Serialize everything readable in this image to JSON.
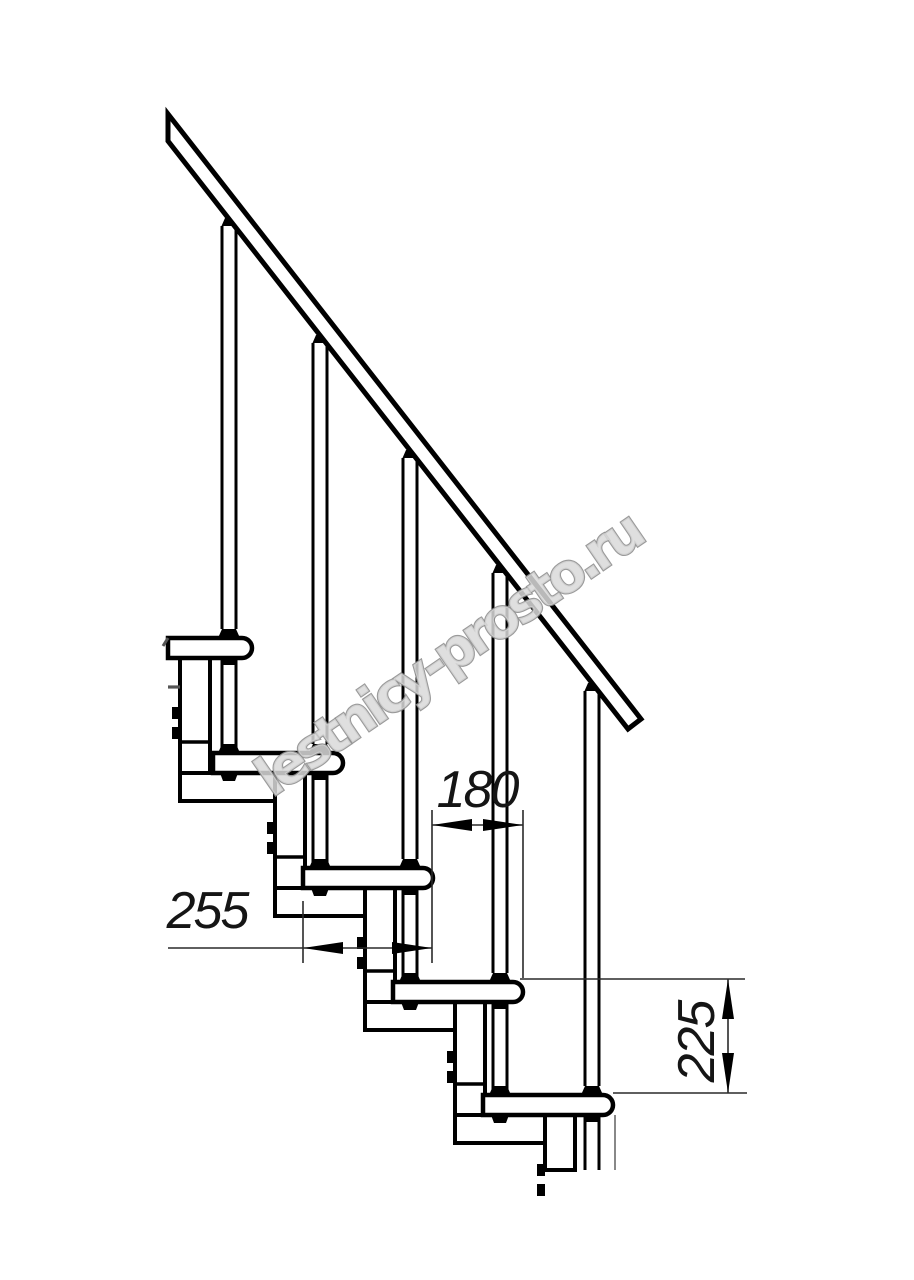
{
  "page": {
    "width": 914,
    "height": 1280,
    "background": "#ffffff"
  },
  "drawing": {
    "subject": "modular-staircase-side-elevation",
    "colors": {
      "outline": "#000000",
      "fill": "#ffffff",
      "dim_line": "#2a2a2a",
      "dim_text": "#151515",
      "thin_edge": "#555555",
      "watermark_fill": "#d9d9d9",
      "watermark_stroke": "#8f8f8f"
    },
    "tread": {
      "height": 20,
      "corner_radius": 10,
      "length_mm": 255
    },
    "steps": [
      {
        "tread_left": 168,
        "tread_top": 638,
        "tread_right": 252,
        "post_x": 229,
        "plate_left": 180
      },
      {
        "tread_left": 213,
        "tread_top": 753,
        "tread_right": 343,
        "post_x": 320,
        "plate_left": 275
      },
      {
        "tread_left": 303,
        "tread_top": 868,
        "tread_right": 433,
        "post_x": 410,
        "plate_left": 365
      },
      {
        "tread_left": 393,
        "tread_top": 982,
        "tread_right": 523,
        "post_x": 500,
        "plate_left": 455
      },
      {
        "tread_left": 483,
        "tread_top": 1095,
        "tread_right": 613,
        "post_x": 592,
        "plate_left": 545
      }
    ],
    "rail": {
      "polygon": "168,114 641,719 628,729 168,141"
    },
    "rail_attach_y": [
      218,
      335,
      450,
      565,
      683
    ],
    "plate": {
      "width": 30,
      "foot_height": 28,
      "bolt_offsets": [
        69,
        89
      ],
      "bolt_w": 8,
      "bolt_h": 12,
      "divider_above_next_top": 11
    },
    "cut_y": 1170,
    "extra_lines": [
      {
        "x1": 168,
        "y1": 687,
        "x2": 180,
        "y2": 687,
        "w": 3.2
      },
      {
        "x1": 168,
        "y1": 638,
        "x2": 163,
        "y2": 646,
        "w": 3.0
      },
      {
        "x1": 615,
        "y1": 1115,
        "x2": 615,
        "y2": 1170,
        "w": 1.4
      }
    ],
    "dimensions": [
      {
        "value": "180",
        "orientation": "horizontal",
        "line_y": 825,
        "from_x": 432,
        "to_x": 523,
        "text_x": 477,
        "text_y": 807,
        "extensions": [
          {
            "x": 432,
            "y1": 810,
            "y2": 963
          },
          {
            "x": 523,
            "y1": 810,
            "y2": 978
          }
        ]
      },
      {
        "value": "255",
        "orientation": "horizontal",
        "line_y": 948,
        "from_x": 303,
        "to_x": 432,
        "tail_x": 168,
        "text_x": 207,
        "text_y": 928,
        "extensions": [
          {
            "x": 303,
            "y1": 901,
            "y2": 963
          }
        ]
      },
      {
        "value": "225",
        "orientation": "vertical",
        "line_x": 728,
        "from_y": 979,
        "to_y": 1093,
        "text_x": 714,
        "text_y": 1042,
        "extensions": [
          {
            "y": 979,
            "x1": 520,
            "x2": 745
          },
          {
            "y": 1093,
            "x1": 613,
            "x2": 747
          }
        ]
      }
    ],
    "arrow": {
      "length": 40,
      "half_width": 6
    },
    "watermark": {
      "text": "lestnicy-prosto.ru",
      "x": 272,
      "y": 798,
      "angle": -34.5,
      "font_size": 54
    }
  }
}
